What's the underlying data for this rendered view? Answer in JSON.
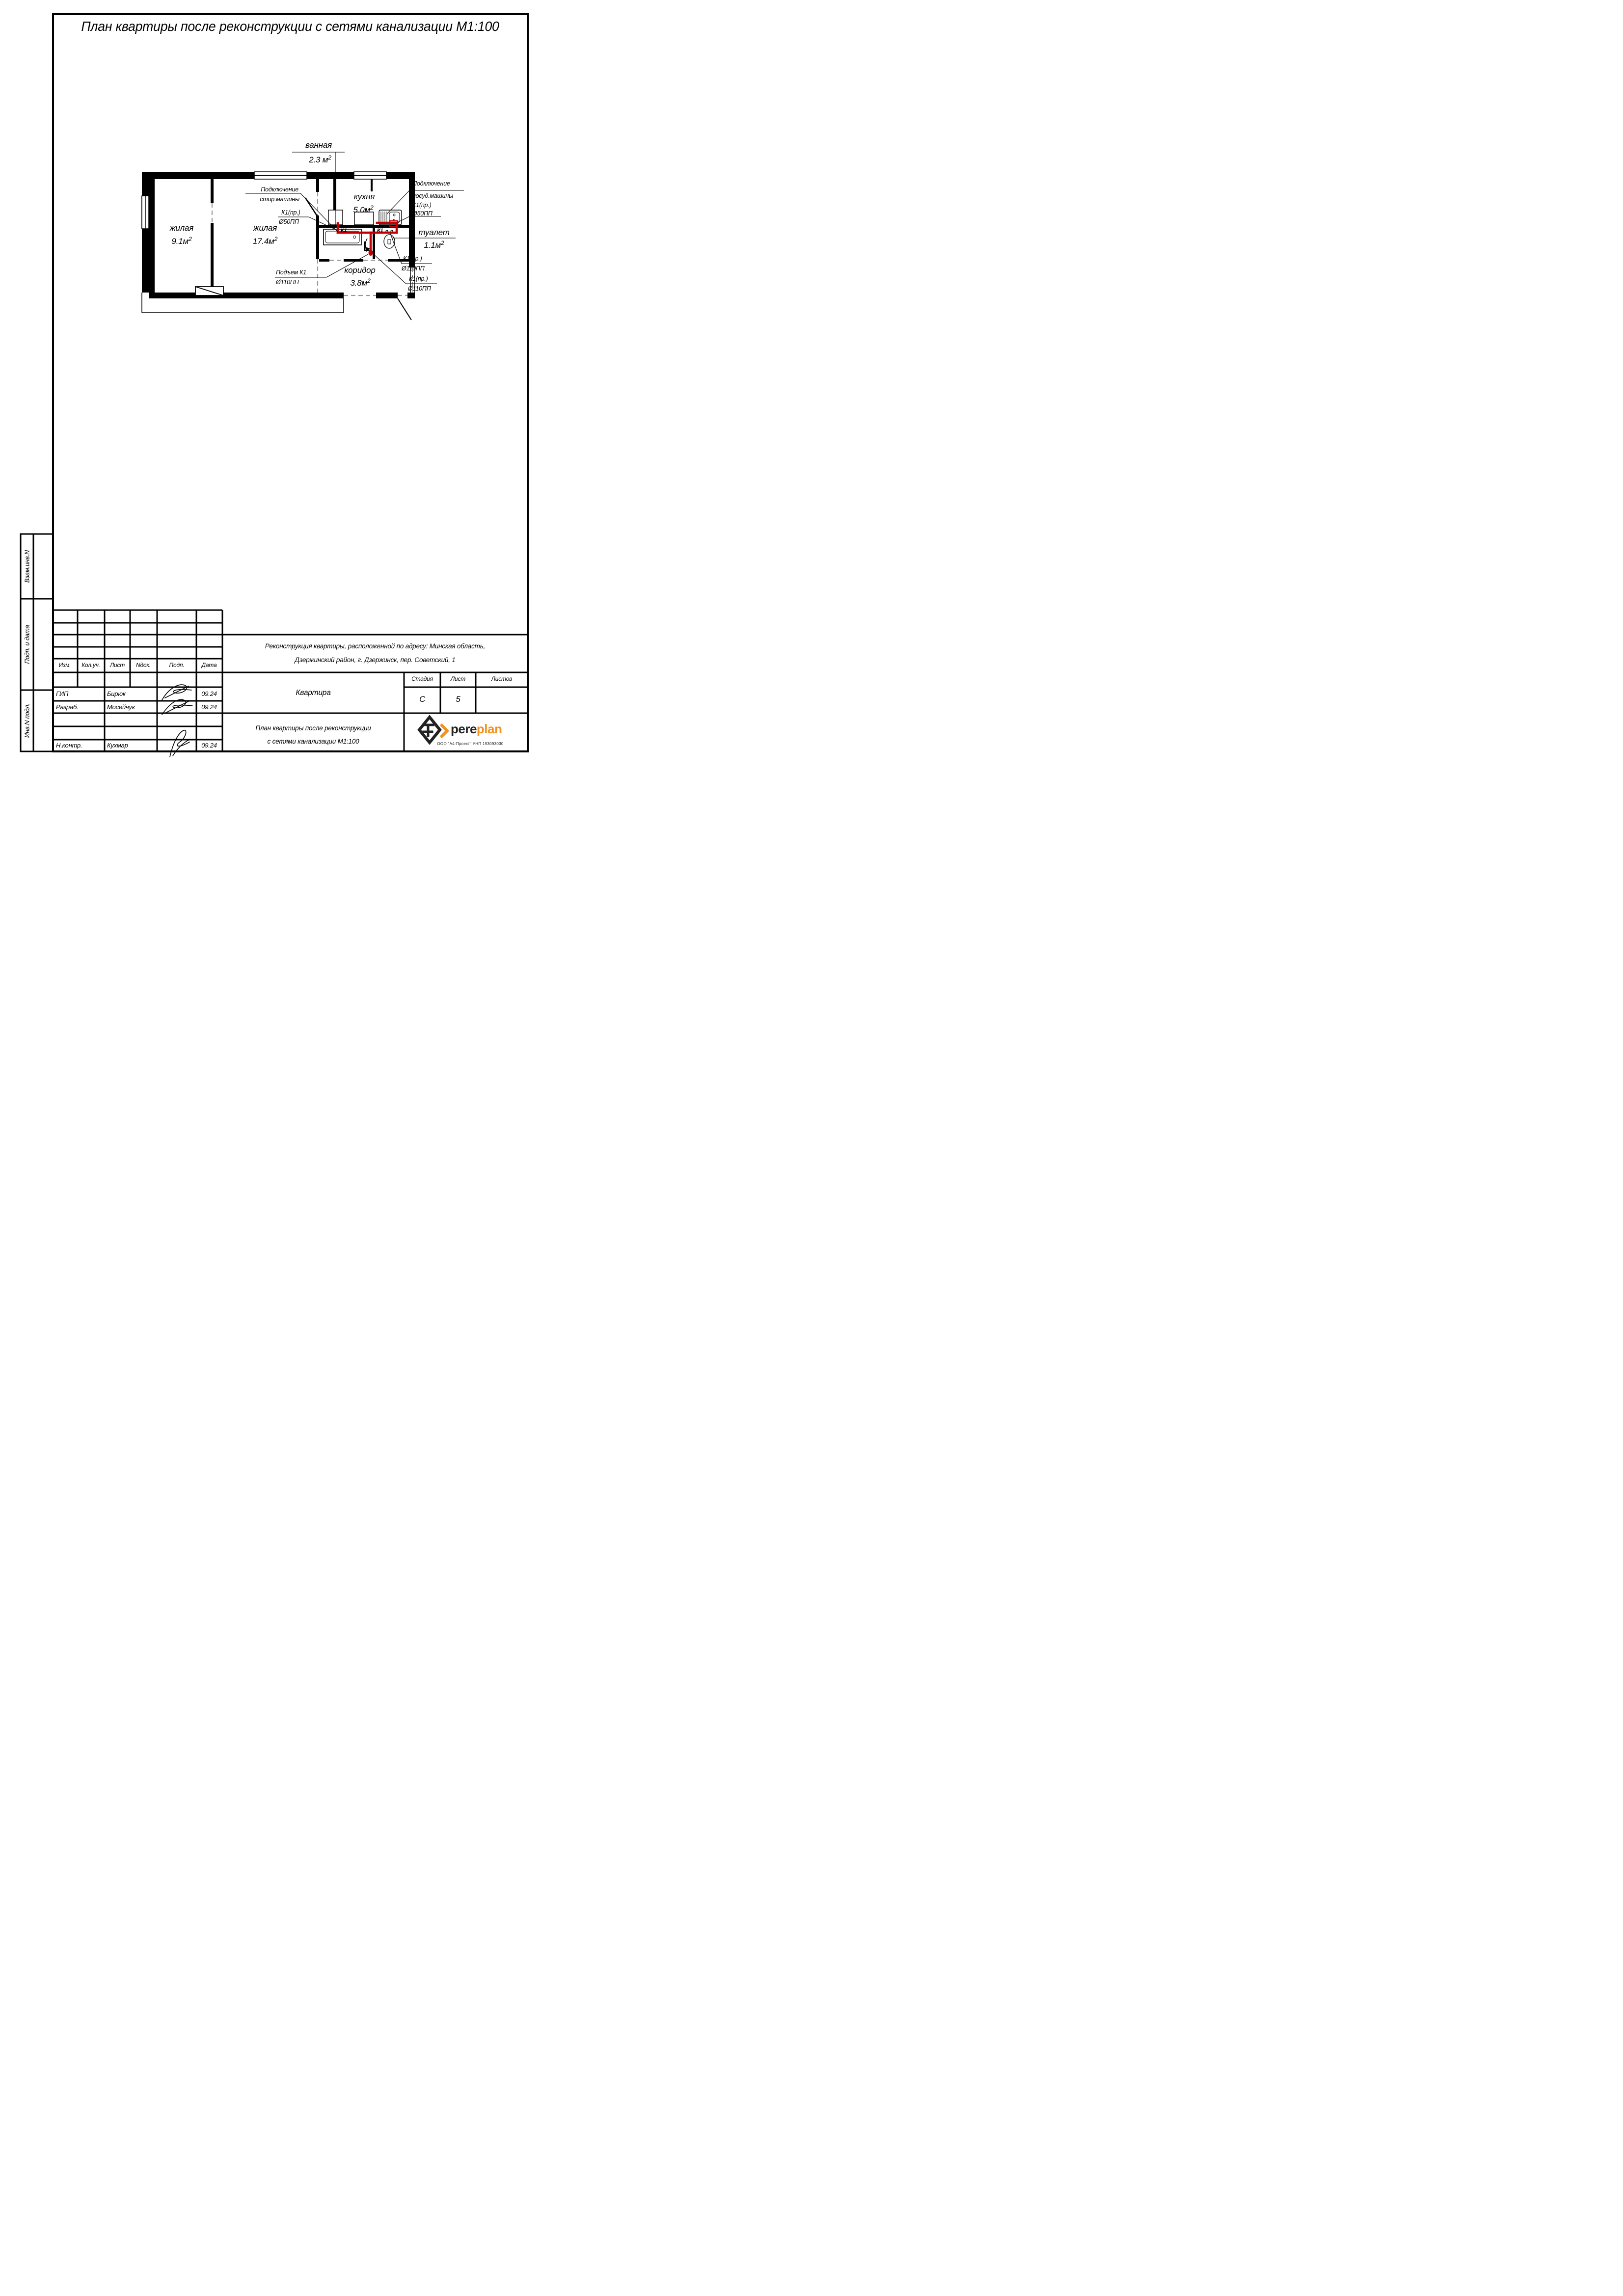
{
  "sheet_title": "План квартиры после реконструкции с сетями канализации М1:100",
  "plan": {
    "colors": {
      "pipe": "#c00000"
    },
    "rooms": [
      {
        "name": "жилая",
        "area": "9.1м",
        "sup": "2"
      },
      {
        "name": "жилая",
        "area": "17.4м",
        "sup": "2"
      },
      {
        "name": "кухня",
        "area": "5.0м",
        "sup": "2"
      },
      {
        "name": "коридор",
        "area": "3.8м",
        "sup": "2"
      },
      {
        "name": "туалет",
        "area": "1.1м",
        "sup": "2"
      },
      {
        "name": "ванная",
        "area": "2.3 м",
        "sup": "2"
      }
    ],
    "annotations": {
      "washer_line1": "Подключение",
      "washer_line2": "стир.машины",
      "washer_pipe_line1": "К1(пр.)",
      "washer_pipe_line2": "Ø50ПП",
      "dishwasher_line1": "Подключение",
      "dishwasher_line2": "посуд.машины",
      "dishwasher_line3": "К1(пр.)",
      "dishwasher_line4": "Ø50ПП",
      "toilet_pipe_line1": "К1(пр.)",
      "toilet_pipe_line2": "Ø110ПП",
      "corridor_pipe_line1": "К1(пр.)",
      "corridor_pipe_line2": "Ø110ПП",
      "riser_line1": "Подъем К1",
      "riser_line2": "Ø110ПП",
      "pipe_label_1": "К1",
      "pipe_label_2": "К1"
    }
  },
  "sidebar": {
    "items": [
      {
        "label": "Взам.инв.N"
      },
      {
        "label": "Подп. и дата"
      },
      {
        "label": "Инв.N подл."
      }
    ]
  },
  "title_block": {
    "revision_headers": [
      "Изм.",
      "Кол.уч.",
      "Лист",
      "Nдок.",
      "Подп.",
      "Дата"
    ],
    "project_line1": "Реконструкция квартиры, расположенной по адресу: Минская область,",
    "project_line2": "Дзержинский район, г. Дзержинск, пер. Советский, 1",
    "object_name": "Квартира",
    "stage_label": "Стадия",
    "sheet_label": "Лист",
    "sheets_label": "Листов",
    "stage_value": "С",
    "sheet_value": "5",
    "sheets_value": "",
    "drawing_title_line1": "План квартиры после реконструкции",
    "drawing_title_line2": "с сетями канализации М1:100",
    "signers": [
      {
        "role": "ГИП",
        "name": "Бирюк",
        "date": "09.24"
      },
      {
        "role": "Разраб.",
        "name": "Мосейчук",
        "date": "09.24"
      },
      {
        "role": "Н.контр.",
        "name": "Кухмар",
        "date": "09.24"
      }
    ],
    "logo": {
      "text_black": "pere",
      "text_orange": "plan",
      "orange_color": "#f5901e",
      "company": "ООО \"А4-Проект\" УНП 193093030"
    }
  }
}
